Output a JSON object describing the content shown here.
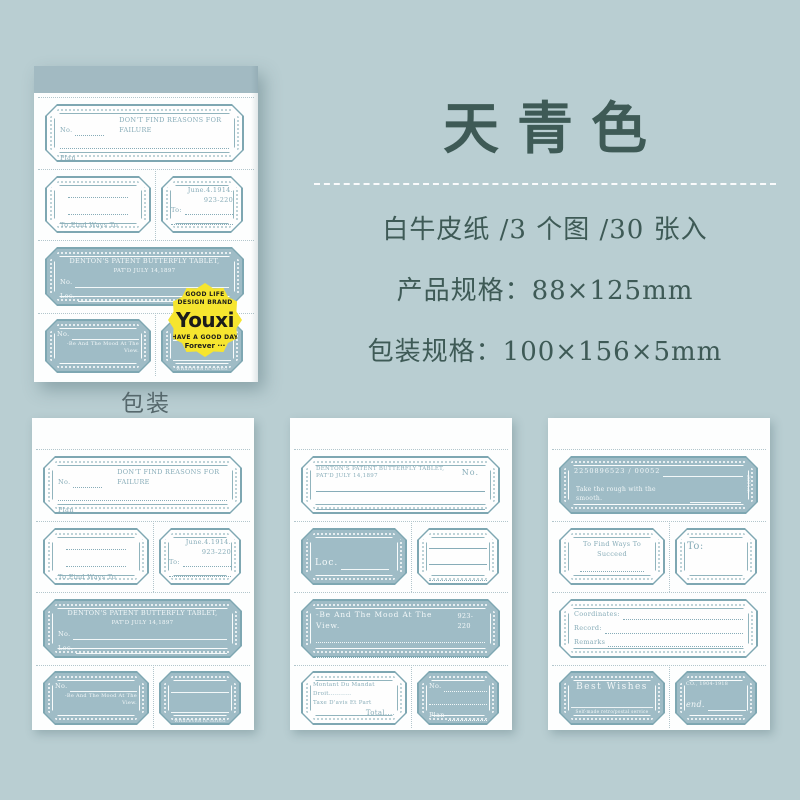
{
  "colors": {
    "background": "#b9ced2",
    "sheet_white": "#fdfefe",
    "label_line_teal": "#7ea7b2",
    "label_fill_blue": "#9fbcc6",
    "binding_band": "#a2bac2",
    "ink_dark_teal": "#3e5a56",
    "badge_yellow": "#f6e52f",
    "badge_text": "#1c1c1a"
  },
  "panel": {
    "title": "天青色",
    "spec_line1": "白牛皮纸 /3 个图 /30 张入",
    "spec_line2": "产品规格：88×125mm",
    "spec_line3": "包装规格：100×156×5mm"
  },
  "caption": "包装",
  "badge": {
    "top1": "GOOD LIFE",
    "top2": "DESIGN BRAND",
    "logo": "Youxi",
    "bottom1": "HAVE A GOOD DAY",
    "bottom2": "Forever ···"
  },
  "designA": {
    "no_label": "No.",
    "title": "DON'T FIND REASONS FOR FAILURE",
    "plan_label": "Plan",
    "succeed_caption": "To Find Ways To Succeed",
    "date": "June.4.1914.",
    "code": "923-220",
    "to_label": "To:",
    "denton_line1": "DENTON'S PATENT BUTTERFLY TABLET,",
    "denton_line2": "PAT'D JULY 14,1897",
    "no2": "No.",
    "loc_label": "Loc.",
    "mood_no": "No.",
    "mood_caption": "-Be And The Mood At The View.",
    "well_caption": "WHATEVER IS GOING WELL."
  },
  "designB": {
    "denton_line1": "DENTON'S PATENT BUTTERFLY TABLET,",
    "denton_line2": "PAT'D JULY 14,1897",
    "no_label": "No.",
    "loc_label": "Loc.",
    "mood_caption": "-Be And The Mood At The View.",
    "code": "923-220",
    "date": "June.4.1914.",
    "mandat_l1": "Montant Du Mandat",
    "mandat_l2": "Droit...........",
    "mandat_l3": "Taxe D'avis Et Part",
    "mandat_l4": "Total....",
    "no2": "No.",
    "plan_label": "Plan"
  },
  "designC": {
    "serial": "2250896523 / 00052",
    "side_mark": "2894.r.",
    "rough_caption": "Take the rough with the smooth.",
    "succeed_caption": "To Find Ways To Succeed",
    "to_label": "To:",
    "coord_label": "Coordinates:",
    "record_label": "Record:",
    "remarks_label": "Remarks",
    "wishes_title": "Best Wishes",
    "wishes_sub": "Self-made retro/postal service",
    "co_label": "CO., 1904-1918",
    "end_label": "end."
  }
}
